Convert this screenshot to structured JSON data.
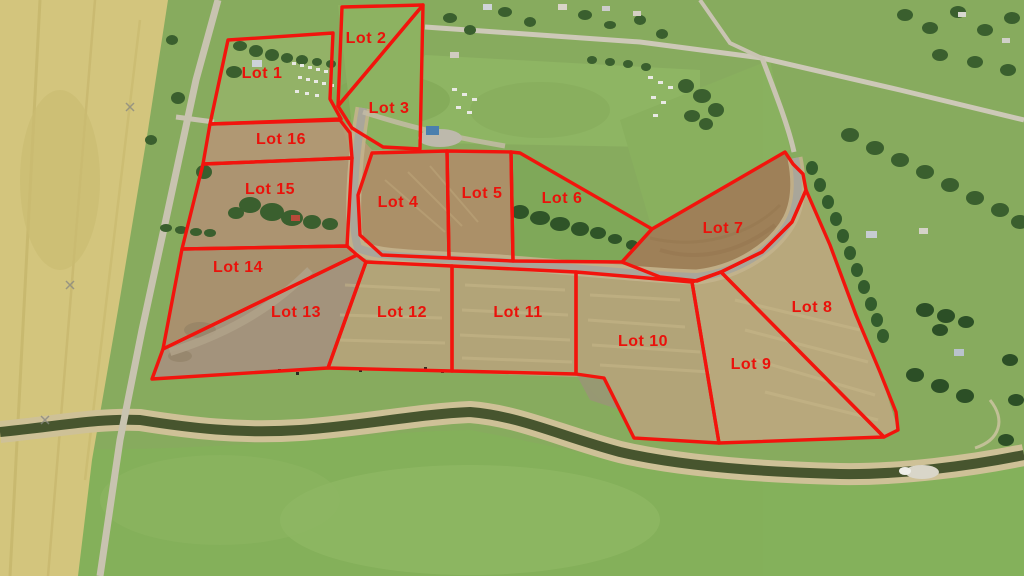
{
  "map": {
    "type": "aerial-lot-plan",
    "boundary_color": "#f2140d",
    "label_color": "#ea120b",
    "label_font_size": 16,
    "boundary_width": 3.4,
    "lots": [
      {
        "id": "lot-1",
        "label": "Lot 1",
        "label_x": 262,
        "label_y": 78,
        "points": "228,40 333,33 330,99 341,119 210,124"
      },
      {
        "id": "lot-2",
        "label": "Lot 2",
        "label_x": 366,
        "label_y": 43,
        "points": "342,7 423,5 338,106"
      },
      {
        "id": "lot-3",
        "label": "Lot 3",
        "label_x": 389,
        "label_y": 113,
        "points": "423,5 420,149 383,147 352,128 338,106"
      },
      {
        "id": "lot-4",
        "label": "Lot 4",
        "label_x": 398,
        "label_y": 207,
        "points": "372,153 447,151 449,258 382,255 360,235 358,195"
      },
      {
        "id": "lot-5",
        "label": "Lot 5",
        "label_x": 482,
        "label_y": 198,
        "points": "447,151 511,152 513,261 449,258"
      },
      {
        "id": "lot-6",
        "label": "Lot 6",
        "label_x": 562,
        "label_y": 203,
        "points": "511,152 520,153 652,229 622,262 513,261"
      },
      {
        "id": "lot-7",
        "label": "Lot 7",
        "label_x": 723,
        "label_y": 233,
        "points": "652,229 785,152 793,164 803,174 806,190 792,222 762,252 721,272 697,281 660,277 622,262"
      },
      {
        "id": "lot-8",
        "label": "Lot 8",
        "label_x": 812,
        "label_y": 312,
        "points": "721,272 762,252 792,222 806,190 830,245 856,315 880,372 896,412 898,430 884,437"
      },
      {
        "id": "lot-9",
        "label": "Lot 9",
        "label_x": 751,
        "label_y": 369,
        "points": "692,282 721,272 884,437 719,443"
      },
      {
        "id": "lot-10",
        "label": "Lot 10",
        "label_x": 643,
        "label_y": 346,
        "points": "576,272 635,277 692,282 719,443 634,438 604,378 576,374"
      },
      {
        "id": "lot-11",
        "label": "Lot 11",
        "label_x": 518,
        "label_y": 317,
        "points": "452,266 576,272 576,374 452,371"
      },
      {
        "id": "lot-12",
        "label": "Lot 12",
        "label_x": 402,
        "label_y": 317,
        "points": "366,262 452,266 452,371 328,368"
      },
      {
        "id": "lot-13",
        "label": "Lot 13",
        "label_x": 296,
        "label_y": 317,
        "points": "163,349 357,255 366,262 328,368 152,379"
      },
      {
        "id": "lot-14",
        "label": "Lot 14",
        "label_x": 238,
        "label_y": 272,
        "points": "182,249 347,246 357,255 163,349"
      },
      {
        "id": "lot-15",
        "label": "Lot 15",
        "label_x": 270,
        "label_y": 194,
        "points": "203,164 352,158 347,246 182,249"
      },
      {
        "id": "lot-16",
        "label": "Lot 16",
        "label_x": 281,
        "label_y": 144,
        "points": "210,124 340,120 350,133 352,158 203,164"
      }
    ]
  }
}
